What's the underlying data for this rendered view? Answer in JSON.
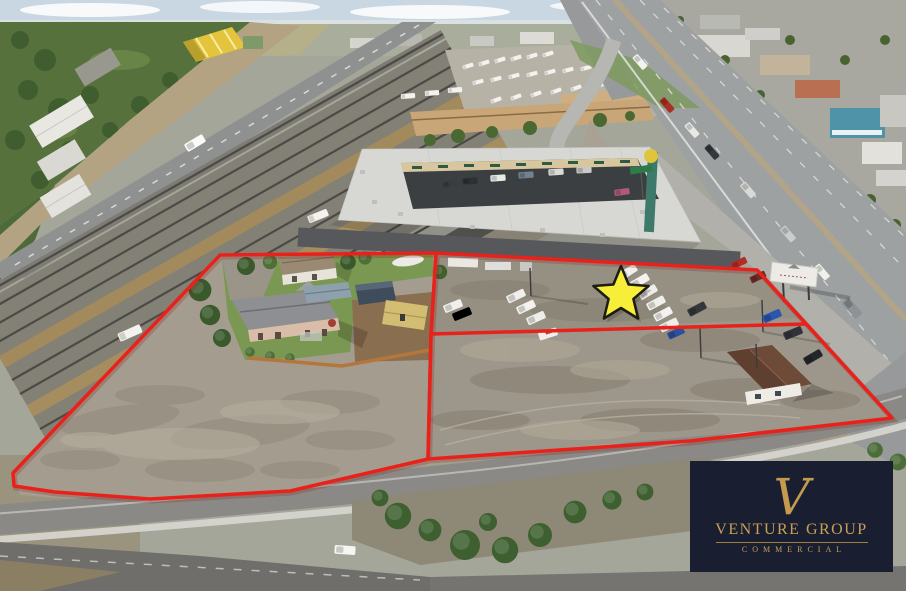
{
  "image": {
    "kind": "aerial-drone-photo",
    "subject": "commercial land listing with two outlined parcels beside a highway and railroad tracks",
    "width": 906,
    "height": 591
  },
  "overlay": {
    "boundary_color": "#e8221b",
    "parcel_count": 2,
    "marker": "star",
    "marker_fill": "#f6ee38",
    "marker_outline": "#1c1c14"
  },
  "branding": {
    "monogram": "V",
    "name": "VENTURE GROUP",
    "tagline": "COMMERCIAL",
    "panel_bg": "#1a1e31",
    "gold": "#c7a055"
  }
}
